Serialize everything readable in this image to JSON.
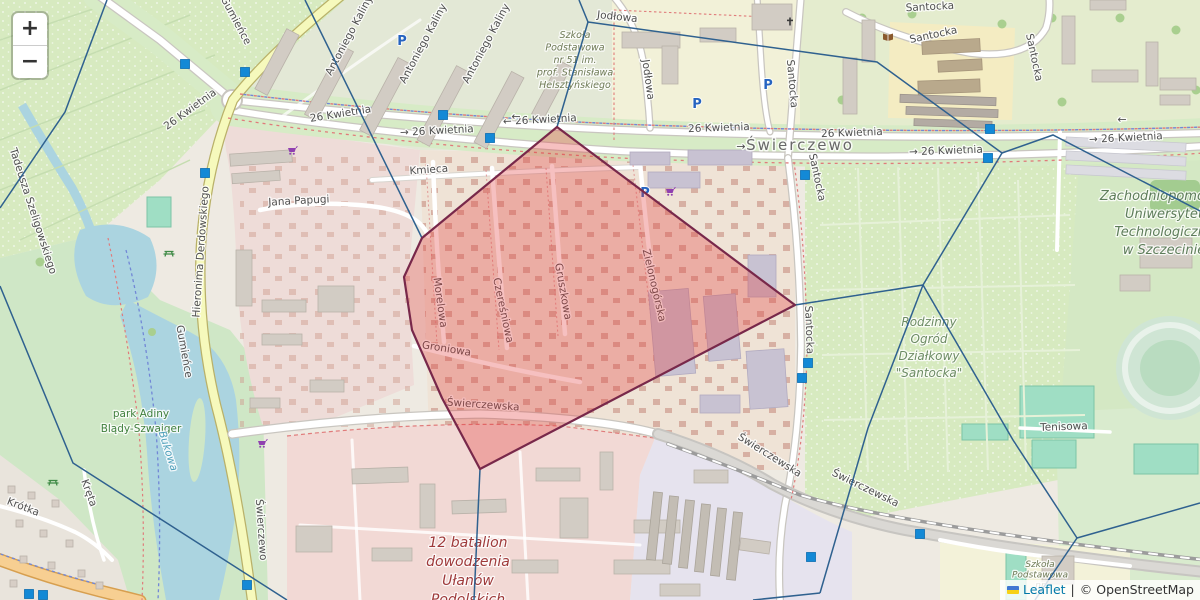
{
  "controls": {
    "zoom_in_label": "+",
    "zoom_out_label": "−"
  },
  "attribution": {
    "flag_icon": "ukraine-flag",
    "leaflet_link": "Leaflet",
    "separator": "|",
    "osm_text": "© OpenStreetMap"
  },
  "overlay": {
    "highlight_cell": {
      "fill": "#e23b3b",
      "fill_opacity": 0.32,
      "stroke": "#78284a",
      "points": [
        [
          557,
          127
        ],
        [
          795,
          305
        ],
        [
          480,
          469
        ],
        [
          442,
          398
        ],
        [
          412,
          330
        ],
        [
          404,
          277
        ],
        [
          422,
          238
        ]
      ]
    },
    "edge_color": "#2f618f",
    "voronoi_edges": [
      [
        [
          107,
          0
        ],
        [
          65,
          112
        ],
        [
          0,
          208
        ]
      ],
      [
        [
          0,
          286
        ],
        [
          73,
          463
        ],
        [
          287,
          600
        ]
      ],
      [
        [
          305,
          0
        ],
        [
          422,
          238
        ]
      ],
      [
        [
          579,
          0
        ],
        [
          588,
          22
        ]
      ],
      [
        [
          588,
          22
        ],
        [
          877,
          62
        ],
        [
          1002,
          153
        ]
      ],
      [
        [
          588,
          22
        ],
        [
          557,
          127
        ]
      ],
      [
        [
          1002,
          153
        ],
        [
          1053,
          135
        ],
        [
          1200,
          211
        ]
      ],
      [
        [
          1002,
          153
        ],
        [
          923,
          285
        ]
      ],
      [
        [
          923,
          285
        ],
        [
          795,
          305
        ]
      ],
      [
        [
          923,
          285
        ],
        [
          868,
          428
        ],
        [
          820,
          593
        ]
      ],
      [
        [
          820,
          593
        ],
        [
          753,
          600
        ]
      ],
      [
        [
          923,
          285
        ],
        [
          1013,
          440
        ],
        [
          1077,
          538
        ]
      ],
      [
        [
          1077,
          538
        ],
        [
          1200,
          503
        ]
      ],
      [
        [
          1077,
          538
        ],
        [
          1035,
          600
        ]
      ],
      [
        [
          480,
          469
        ],
        [
          474,
          600
        ]
      ]
    ],
    "marker_color": "#1389d6",
    "markers": [
      [
        185,
        64
      ],
      [
        245,
        72
      ],
      [
        205,
        173
      ],
      [
        443,
        115
      ],
      [
        490,
        138
      ],
      [
        805,
        175
      ],
      [
        990,
        129
      ],
      [
        988,
        158
      ],
      [
        808,
        363
      ],
      [
        802,
        378
      ],
      [
        247,
        585
      ],
      [
        811,
        557
      ],
      [
        920,
        534
      ],
      [
        29,
        594
      ],
      [
        43,
        595
      ]
    ]
  },
  "labels": {
    "district": [
      {
        "t": "Świerczewo",
        "x": 800,
        "y": 150
      }
    ],
    "streets": [
      {
        "t": "26 Kwietnia",
        "x": 192,
        "y": 112,
        "r": -36
      },
      {
        "t": "26 Kwietnia",
        "x": 341,
        "y": 117,
        "r": -9
      },
      {
        "t": "→ 26 Kwietnia",
        "x": 437,
        "y": 134,
        "r": -3
      },
      {
        "t": "← 26 Kwietnia",
        "x": 540,
        "y": 123,
        "r": -3
      },
      {
        "t": "26 Kwietnia",
        "x": 719,
        "y": 131,
        "r": -2
      },
      {
        "t": "26 Kwietnia",
        "x": 852,
        "y": 136,
        "r": -2
      },
      {
        "t": "→ 26 Kwietnia",
        "x": 946,
        "y": 154,
        "r": -2
      },
      {
        "t": "→ 26 Kwietnia",
        "x": 1126,
        "y": 141,
        "r": -3
      },
      {
        "t": "Kmieca",
        "x": 429,
        "y": 173,
        "r": -4
      },
      {
        "t": "Jana Papugi",
        "x": 299,
        "y": 204,
        "r": -3
      },
      {
        "t": "Hieronima Derdowskiego",
        "x": 204,
        "y": 252,
        "r": -86
      },
      {
        "t": "Tadeusza Szeligowskiego",
        "x": 30,
        "y": 212,
        "r": 72
      },
      {
        "t": "Gumieńce",
        "x": 233,
        "y": 22,
        "r": 62
      },
      {
        "t": "Gumieńce",
        "x": 181,
        "y": 352,
        "r": 80
      },
      {
        "t": "Santocka",
        "x": 930,
        "y": 10,
        "r": -3
      },
      {
        "t": "Santocka",
        "x": 934,
        "y": 38,
        "r": -12
      },
      {
        "t": "Santocka",
        "x": 1031,
        "y": 58,
        "r": 78
      },
      {
        "t": "Santocka",
        "x": 789,
        "y": 84,
        "r": 85
      },
      {
        "t": "Santocka",
        "x": 814,
        "y": 178,
        "r": 78
      },
      {
        "t": "Santocka",
        "x": 806,
        "y": 330,
        "r": 88
      },
      {
        "t": "Jodłowa",
        "x": 617,
        "y": 20,
        "r": 6
      },
      {
        "t": "Jodłowa",
        "x": 645,
        "y": 80,
        "r": 82
      },
      {
        "t": "Antoniego Kaliny",
        "x": 352,
        "y": 37,
        "r": -62
      },
      {
        "t": "Antoniego Kaliny",
        "x": 426,
        "y": 45,
        "r": -62
      },
      {
        "t": "Antoniego Kaliny",
        "x": 489,
        "y": 45,
        "r": -62
      },
      {
        "t": "Morelowa",
        "x": 437,
        "y": 303,
        "r": 82
      },
      {
        "t": "Czereśniowa",
        "x": 500,
        "y": 311,
        "r": 78
      },
      {
        "t": "Gruszkowa",
        "x": 560,
        "y": 292,
        "r": 80
      },
      {
        "t": "Zielonogórska",
        "x": 651,
        "y": 286,
        "r": 77
      },
      {
        "t": "Groniowa",
        "x": 446,
        "y": 352,
        "r": 9
      },
      {
        "t": "Świerczewska",
        "x": 483,
        "y": 408,
        "r": 4
      },
      {
        "t": "Świerczewska",
        "x": 768,
        "y": 458,
        "r": 32
      },
      {
        "t": "Świerczewska",
        "x": 864,
        "y": 491,
        "r": 26
      },
      {
        "t": "Krótka",
        "x": 22,
        "y": 510,
        "r": 21
      },
      {
        "t": "Kręta",
        "x": 86,
        "y": 494,
        "r": 70
      },
      {
        "t": "Świerczewo",
        "x": 258,
        "y": 530,
        "r": 86
      },
      {
        "t": "Tenisowa",
        "x": 1064,
        "y": 430,
        "r": -2
      }
    ],
    "arrows": [
      {
        "t": "→",
        "x": 741,
        "y": 150
      },
      {
        "t": "←",
        "x": 1122,
        "y": 123
      },
      {
        "t": "←",
        "x": 516,
        "y": 120
      }
    ],
    "places": [
      {
        "lines": [
          "Szkoła",
          "Podstawowa",
          "nr 51 im.",
          "prof. Stanisława",
          "Helsztyńskiego"
        ],
        "x": 575,
        "y": 38,
        "dy": 12.5,
        "size": 9.5,
        "color": "#6e7a55",
        "italic": true
      },
      {
        "lines": [
          "park Adiny",
          "Blądy-Szwajger"
        ],
        "x": 141,
        "y": 417,
        "dy": 15,
        "size": 10.5,
        "color": "#41803e",
        "italic": false
      },
      {
        "lines": [
          "Bukowa"
        ],
        "x": 165,
        "y": 452,
        "dy": 14,
        "size": 10.5,
        "color": "#4d9fba",
        "italic": true,
        "r": 72
      },
      {
        "lines": [
          "12 batalion",
          "dowodzenia",
          "Ułanów",
          "Podolskich"
        ],
        "x": 468,
        "y": 547,
        "dy": 19,
        "size": 14,
        "color": "#9e3a3a",
        "italic": true
      },
      {
        "lines": [
          "Rodzinny",
          "Ogród",
          "Działkowy",
          "\"Santocka\""
        ],
        "x": 929,
        "y": 326,
        "dy": 17,
        "size": 12,
        "color": "#6d8c64",
        "italic": true
      },
      {
        "lines": [
          "Zachodniopomorski",
          "Uniwersytet",
          "Technologiczny",
          "w Szczecinie"
        ],
        "x": 1164,
        "y": 200,
        "dy": 18,
        "size": 13,
        "color": "#5e7d5a",
        "italic": true
      },
      {
        "lines": [
          "Szkoła",
          "Podstawowa",
          "nr"
        ],
        "x": 1040,
        "y": 567,
        "dy": 10.5,
        "size": 9,
        "color": "#6e7a55",
        "italic": true
      }
    ]
  },
  "pois": {
    "parking": [
      [
        402,
        41
      ],
      [
        697,
        104
      ],
      [
        768,
        85
      ],
      [
        645,
        193
      ]
    ],
    "supermarket": [
      [
        292,
        151
      ],
      [
        670,
        192
      ],
      [
        262,
        444
      ]
    ],
    "library": [
      [
        888,
        37
      ]
    ],
    "church": [
      [
        790,
        22
      ]
    ],
    "picnic": [
      [
        169,
        253
      ],
      [
        53,
        482
      ]
    ]
  }
}
